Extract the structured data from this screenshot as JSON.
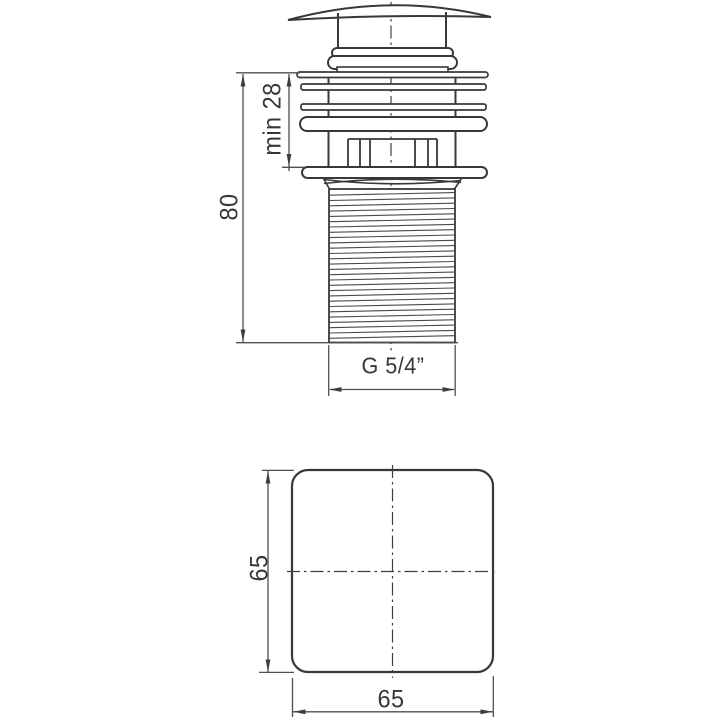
{
  "colors": {
    "background": "#ffffff",
    "object_line": "#383838",
    "dimension_line": "#4f4f4f",
    "text": "#373737"
  },
  "front_view": {
    "dim_min_height": {
      "label": "min 28"
    },
    "dim_total_height": {
      "label": "80"
    },
    "dim_thread": {
      "label": "G 5/4”"
    }
  },
  "plan_view": {
    "dim_side": {
      "label": "65"
    },
    "dim_width": {
      "label": "65"
    }
  }
}
